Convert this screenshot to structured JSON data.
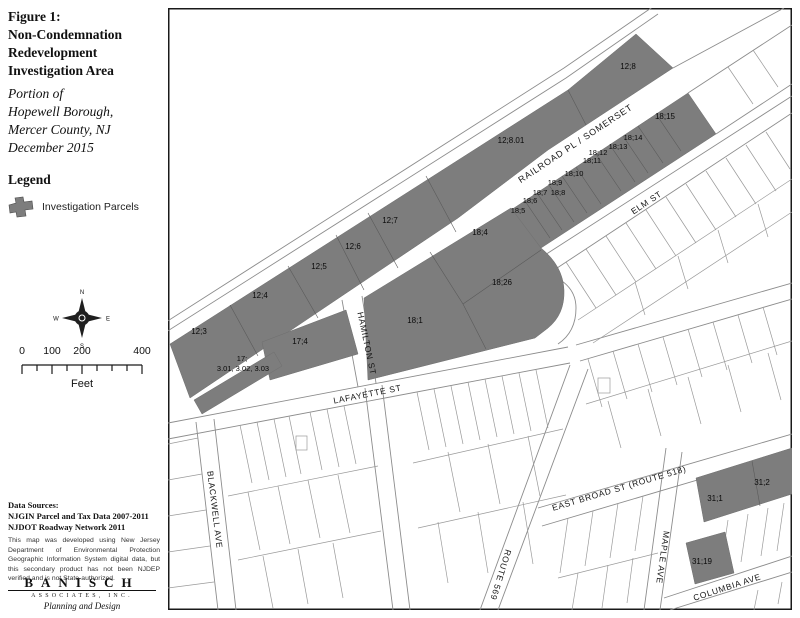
{
  "figure": {
    "title_lines": [
      "Figure 1:",
      "Non-Condemnation",
      "Redevelopment",
      "Investigation Area"
    ],
    "subtitle_lines": [
      "Portion of",
      "Hopewell Borough,",
      "Mercer County, NJ",
      "December 2015"
    ]
  },
  "legend": {
    "heading": "Legend",
    "parcels_label": "Investigation Parcels"
  },
  "compass": {
    "n": "N",
    "e": "E",
    "s": "S",
    "w": "W"
  },
  "scalebar": {
    "t0": "0",
    "t100": "100",
    "t200": "200",
    "t400": "400",
    "unit": "Feet"
  },
  "sources": {
    "heading": "Data Sources:",
    "line1": "NJGIN Parcel and Tax Data 2007-2011",
    "line2": "NJDOT Roadway Network 2011",
    "disclaimer": "This map was developed using New Jersey Department of Environmental Protection Geographic Information System digital data, but this secondary product has not been NJDEP verified and is not State-authorized."
  },
  "logo": {
    "name": "BANISCH",
    "subline": "ASSOCIATES, INC.",
    "tagline": "Planning and Design"
  },
  "map": {
    "streets": {
      "railroad_pl": "RAILROAD PL / SOMERSET",
      "elm_st": "ELM ST",
      "hamilton_st": "HAMILTON ST",
      "lafayette_st": "LAFAYETTE ST",
      "east_broad_st": "EAST BROAD ST (ROUTE 518)",
      "blackwell_ave": "BLACKWELL AVE",
      "maple_ave": "MAPLE AVE",
      "columbia_ave": "COLUMBIA AVE",
      "route_569": "ROUTE 569"
    },
    "parcels": {
      "p12_3": "12;3",
      "p12_4": "12;4",
      "p12_5": "12;5",
      "p12_6": "12;6",
      "p12_7": "12;7",
      "p12_8_01": "12;8.01",
      "p12_8": "12;8",
      "p17": "17;",
      "p17_lots": "3.01, 3.02, 3.03",
      "p17_4": "17;4",
      "p18_1": "18;1",
      "p18_4": "18;4",
      "p18_26": "18;26",
      "p18_5": "18;5",
      "p18_6": "18;6",
      "p18_7": "18;7",
      "p18_8": "18;8",
      "p18_9": "18;9",
      "p18_10": "18;10",
      "p18_11": "18;11",
      "p18_12": "18;12",
      "p18_13": "18;13",
      "p18_14": "18;14",
      "p18_15": "18;15",
      "p31_1": "31;1",
      "p31_2": "31;2",
      "p31_19": "31;19"
    }
  },
  "colors": {
    "parcel_fill": "#7d7d7d",
    "map_line": "#8c8c8c",
    "frame": "#1a1a1a"
  }
}
